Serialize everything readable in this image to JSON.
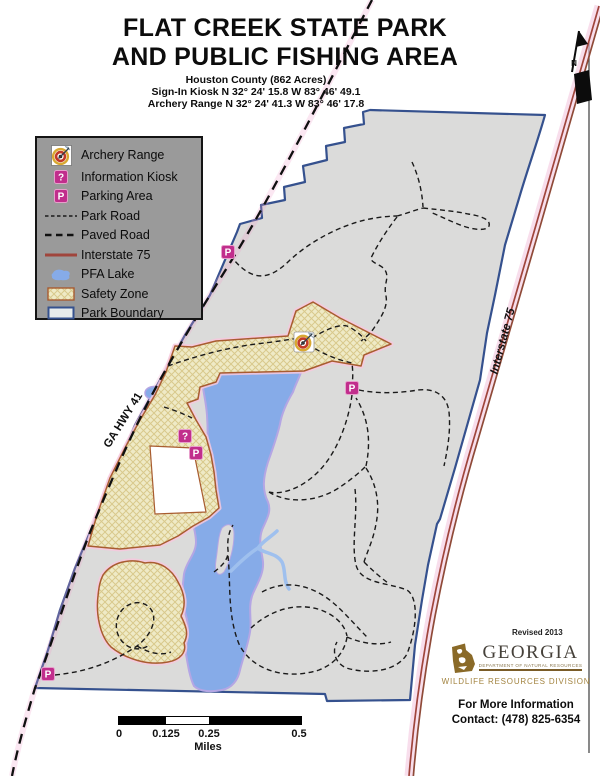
{
  "page": {
    "title_line1": "FLAT CREEK STATE PARK",
    "title_line2": "AND PUBLIC FISHING AREA",
    "subtitle_line1": "Houston County (862 Acres)",
    "subtitle_line2": "Sign-In Kiosk N 32° 24' 15.8 W 83° 46' 49.1",
    "subtitle_line3": "Archery Range N 32° 24' 41.3  W 83° 46' 17.8"
  },
  "legend": {
    "items": [
      {
        "label": "Archery Range"
      },
      {
        "label": "Information Kiosk"
      },
      {
        "label": "Parking Area"
      },
      {
        "label": "Park Road"
      },
      {
        "label": "Paved Road"
      },
      {
        "label": "Interstate 75"
      },
      {
        "label": "PFA Lake"
      },
      {
        "label": "Safety Zone"
      },
      {
        "label": "Park Boundary"
      }
    ]
  },
  "map": {
    "labels": {
      "highway": "GA HWY 41",
      "interstate": "Interstate 75"
    },
    "markers": {
      "parking": "P",
      "info": "?"
    },
    "north": "N"
  },
  "scalebar": {
    "ticks": [
      "0",
      "0.125",
      "0.25",
      "0.5"
    ],
    "unit": "Miles"
  },
  "footer": {
    "revised": "Revised 2013",
    "logo_name": "GEORGIA",
    "logo_dept": "DEPARTMENT OF NATURAL RESOURCES",
    "logo_division": "WILDLIFE RESOURCES DIVISION",
    "info_line1": "For More Information",
    "info_line2": "Contact:  (478) 825-6354"
  },
  "colors": {
    "park_fill": "#dbdbda",
    "boundary_stroke": "#35518e",
    "lake_fill": "#86abe8",
    "lake_fringe": "#b4a6e4",
    "safety_fill": "#efeac6",
    "safety_border": "#a85c30",
    "safety_halo": "#f7c8dd",
    "marker_magenta": "#c12e8c",
    "interstate_red": "#a0453c",
    "legend_bg": "#9a9a9a"
  }
}
